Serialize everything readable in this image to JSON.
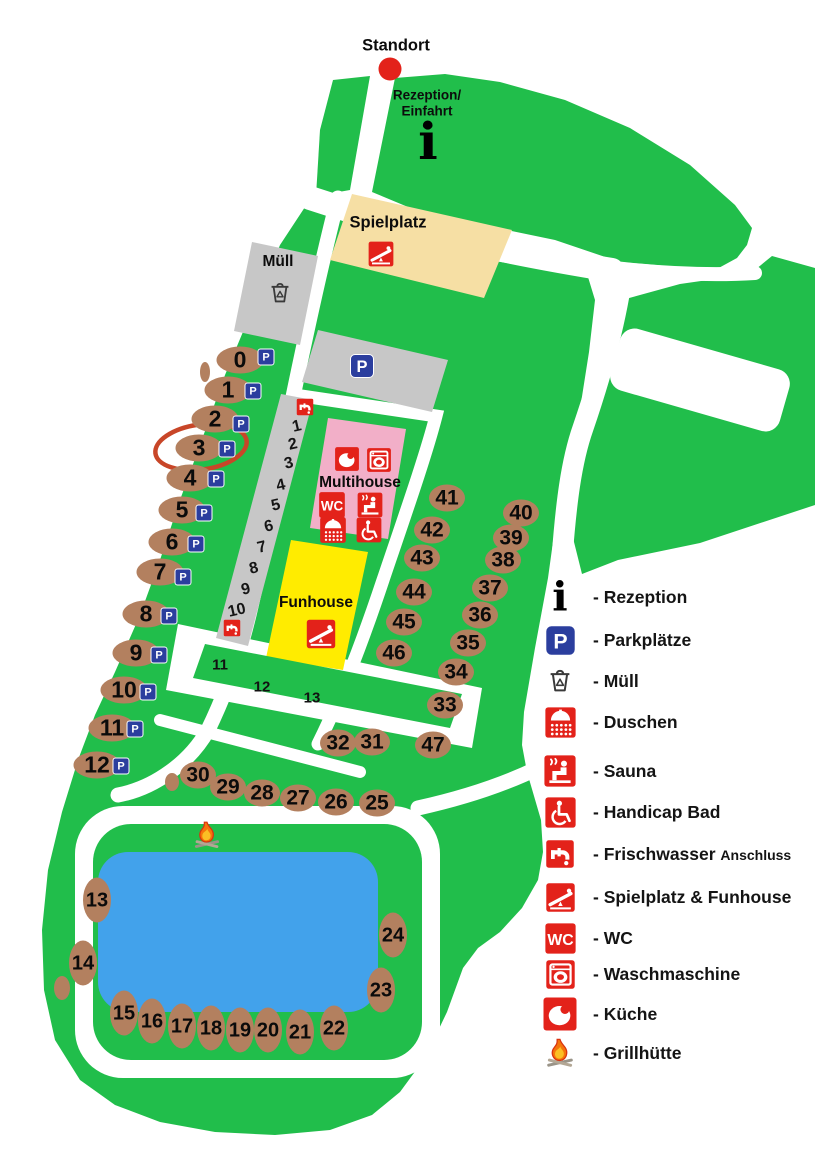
{
  "colors": {
    "green": "#21BE4B",
    "pond": "#42A2EB",
    "pitch": "#B3805F",
    "red": "#E3221A",
    "pink": "#F2AFC8",
    "yellow": "#FFEC00",
    "tan": "#F6DFA4",
    "gray": "#C7C7C7",
    "pblue": "#2B3E9E",
    "highlight": "#C84628",
    "ink": "#0D0D0D"
  },
  "map": {
    "highlighted_pitch": "3",
    "texts": [
      {
        "name": "standort-label",
        "text": "Standort",
        "x": 396,
        "y": 46,
        "cls": "t16"
      },
      {
        "name": "reception-label-line1",
        "text": "Rezeption/",
        "x": 427,
        "y": 95,
        "cls": "t13"
      },
      {
        "name": "reception-label-line2",
        "text": "Einfahrt",
        "x": 427,
        "y": 111,
        "cls": "t13"
      },
      {
        "name": "spielplatz-label",
        "text": "Spielplatz",
        "x": 388,
        "y": 223,
        "cls": "t16"
      },
      {
        "name": "muell-label",
        "text": "Müll",
        "x": 278,
        "y": 262,
        "cls": "t15"
      },
      {
        "name": "multihouse-label",
        "text": "Multihouse",
        "x": 360,
        "y": 483,
        "cls": "t15"
      },
      {
        "name": "funhouse-label",
        "text": "Funhouse",
        "x": 316,
        "y": 603,
        "cls": "t15"
      }
    ],
    "pitches": [
      {
        "n": "0",
        "x": 240,
        "y": 360,
        "o": "h",
        "p": [
          266,
          357
        ]
      },
      {
        "n": "1",
        "x": 228,
        "y": 390,
        "o": "h",
        "p": [
          253,
          391
        ]
      },
      {
        "n": "2",
        "x": 215,
        "y": 419,
        "o": "h",
        "p": [
          241,
          424
        ]
      },
      {
        "n": "3",
        "x": 199,
        "y": 448,
        "o": "h",
        "p": [
          227,
          449
        ]
      },
      {
        "n": "4",
        "x": 190,
        "y": 478,
        "o": "h",
        "p": [
          216,
          479
        ]
      },
      {
        "n": "5",
        "x": 182,
        "y": 510,
        "o": "h",
        "p": [
          204,
          513
        ]
      },
      {
        "n": "6",
        "x": 172,
        "y": 542,
        "o": "h",
        "p": [
          196,
          544
        ]
      },
      {
        "n": "7",
        "x": 160,
        "y": 572,
        "o": "h",
        "p": [
          183,
          577
        ]
      },
      {
        "n": "8",
        "x": 146,
        "y": 614,
        "o": "h",
        "p": [
          169,
          616
        ]
      },
      {
        "n": "9",
        "x": 136,
        "y": 653,
        "o": "h",
        "p": [
          159,
          655
        ]
      },
      {
        "n": "10",
        "x": 124,
        "y": 690,
        "o": "h",
        "p": [
          148,
          692
        ]
      },
      {
        "n": "11",
        "x": 112,
        "y": 728,
        "o": "h",
        "p": [
          135,
          729
        ]
      },
      {
        "n": "12",
        "x": 97,
        "y": 765,
        "o": "h",
        "p": [
          121,
          766
        ]
      },
      {
        "n": "13",
        "x": 97,
        "y": 900,
        "o": "v"
      },
      {
        "n": "14",
        "x": 83,
        "y": 963,
        "o": "v"
      },
      {
        "n": "15",
        "x": 124,
        "y": 1013,
        "o": "v"
      },
      {
        "n": "16",
        "x": 152,
        "y": 1021,
        "o": "v"
      },
      {
        "n": "17",
        "x": 182,
        "y": 1026,
        "o": "v"
      },
      {
        "n": "18",
        "x": 211,
        "y": 1028,
        "o": "v"
      },
      {
        "n": "19",
        "x": 240,
        "y": 1030,
        "o": "v"
      },
      {
        "n": "20",
        "x": 268,
        "y": 1030,
        "o": "v"
      },
      {
        "n": "21",
        "x": 300,
        "y": 1032,
        "o": "v"
      },
      {
        "n": "22",
        "x": 334,
        "y": 1028,
        "o": "v"
      },
      {
        "n": "23",
        "x": 381,
        "y": 990,
        "o": "v"
      },
      {
        "n": "24",
        "x": 393,
        "y": 935,
        "o": "v"
      },
      {
        "n": "25",
        "x": 377,
        "y": 803,
        "o": "m"
      },
      {
        "n": "26",
        "x": 336,
        "y": 802,
        "o": "m"
      },
      {
        "n": "27",
        "x": 298,
        "y": 798,
        "o": "m"
      },
      {
        "n": "28",
        "x": 262,
        "y": 793,
        "o": "m"
      },
      {
        "n": "29",
        "x": 228,
        "y": 787,
        "o": "m"
      },
      {
        "n": "30",
        "x": 198,
        "y": 775,
        "o": "m"
      },
      {
        "n": "31",
        "x": 372,
        "y": 742,
        "o": "m"
      },
      {
        "n": "32",
        "x": 338,
        "y": 743,
        "o": "m"
      },
      {
        "n": "33",
        "x": 445,
        "y": 705,
        "o": "m"
      },
      {
        "n": "34",
        "x": 456,
        "y": 672,
        "o": "m"
      },
      {
        "n": "35",
        "x": 468,
        "y": 643,
        "o": "m"
      },
      {
        "n": "36",
        "x": 480,
        "y": 615,
        "o": "m"
      },
      {
        "n": "37",
        "x": 490,
        "y": 588,
        "o": "m"
      },
      {
        "n": "38",
        "x": 503,
        "y": 560,
        "o": "m"
      },
      {
        "n": "39",
        "x": 511,
        "y": 538,
        "o": "m"
      },
      {
        "n": "40",
        "x": 521,
        "y": 513,
        "o": "m"
      },
      {
        "n": "41",
        "x": 447,
        "y": 498,
        "o": "m"
      },
      {
        "n": "42",
        "x": 432,
        "y": 530,
        "o": "m"
      },
      {
        "n": "43",
        "x": 422,
        "y": 558,
        "o": "m"
      },
      {
        "n": "44",
        "x": 414,
        "y": 592,
        "o": "m"
      },
      {
        "n": "45",
        "x": 404,
        "y": 622,
        "o": "m"
      },
      {
        "n": "46",
        "x": 394,
        "y": 653,
        "o": "m"
      },
      {
        "n": "47",
        "x": 433,
        "y": 745,
        "o": "m"
      }
    ],
    "walkway_numbers": [
      {
        "n": "1",
        "x": 297,
        "y": 427
      },
      {
        "n": "2",
        "x": 293,
        "y": 445
      },
      {
        "n": "3",
        "x": 289,
        "y": 464
      },
      {
        "n": "4",
        "x": 281,
        "y": 486
      },
      {
        "n": "5",
        "x": 276,
        "y": 506
      },
      {
        "n": "6",
        "x": 269,
        "y": 527
      },
      {
        "n": "7",
        "x": 262,
        "y": 548
      },
      {
        "n": "8",
        "x": 254,
        "y": 569
      },
      {
        "n": "9",
        "x": 246,
        "y": 590
      },
      {
        "n": "10",
        "x": 237,
        "y": 611
      }
    ],
    "area_labels": [
      {
        "n": "11",
        "x": 220,
        "y": 665
      },
      {
        "n": "12",
        "x": 262,
        "y": 687
      },
      {
        "n": "13",
        "x": 312,
        "y": 698
      }
    ],
    "facilities": [
      {
        "icon": "info-icon",
        "x": 428,
        "y": 142,
        "s": 46
      },
      {
        "icon": "parking-icon",
        "x": 362,
        "y": 366,
        "s": 24
      },
      {
        "icon": "trash-icon",
        "x": 280,
        "y": 293,
        "s": 27
      },
      {
        "icon": "seesaw-icon",
        "x": 381,
        "y": 254,
        "s": 27
      },
      {
        "icon": "seesaw-icon",
        "x": 321,
        "y": 634,
        "s": 31
      },
      {
        "icon": "kitchen-icon",
        "x": 347,
        "y": 459,
        "s": 26
      },
      {
        "icon": "washer-icon",
        "x": 379,
        "y": 460,
        "s": 26
      },
      {
        "icon": "wc-icon",
        "x": 332,
        "y": 505,
        "s": 28
      },
      {
        "icon": "sauna-icon",
        "x": 370,
        "y": 505,
        "s": 27
      },
      {
        "icon": "shower-icon",
        "x": 333,
        "y": 530,
        "s": 28
      },
      {
        "icon": "handicap-icon",
        "x": 369,
        "y": 530,
        "s": 27
      },
      {
        "icon": "tap-icon",
        "x": 305,
        "y": 407,
        "s": 18
      },
      {
        "icon": "tap-icon",
        "x": 232,
        "y": 628,
        "s": 18
      },
      {
        "icon": "campfire-icon",
        "x": 207,
        "y": 835,
        "s": 32
      }
    ]
  },
  "legend": {
    "x": 542,
    "items": [
      {
        "icon": "info-icon",
        "label": "- Rezeption",
        "y": 597,
        "s": 38
      },
      {
        "icon": "parking-icon",
        "label": "- Parkplätze",
        "y": 640,
        "s": 31
      },
      {
        "icon": "trash-icon",
        "label": "- Müll",
        "y": 681,
        "s": 30
      },
      {
        "icon": "shower-icon",
        "label": "- Duschen",
        "y": 722,
        "s": 33
      },
      {
        "icon": "sauna-icon",
        "label": "- Sauna",
        "y": 771,
        "s": 34
      },
      {
        "icon": "handicap-icon",
        "label": "- Handicap Bad",
        "y": 812,
        "s": 33
      },
      {
        "icon": "tap-icon",
        "label": "- Frischwasser ",
        "label_small": "Anschluss",
        "y": 854,
        "s": 30
      },
      {
        "icon": "seesaw-icon",
        "label": "- Spielplatz & Funhouse",
        "y": 897,
        "s": 31
      },
      {
        "icon": "wc-icon",
        "label": "- WC",
        "y": 938,
        "s": 33
      },
      {
        "icon": "washer-icon",
        "label": "- Waschmaschine",
        "y": 974,
        "s": 31
      },
      {
        "icon": "kitchen-icon",
        "label": "- Küche",
        "y": 1014,
        "s": 36
      },
      {
        "icon": "campfire-icon",
        "label": "- Grillhütte",
        "y": 1053,
        "s": 34
      }
    ]
  }
}
